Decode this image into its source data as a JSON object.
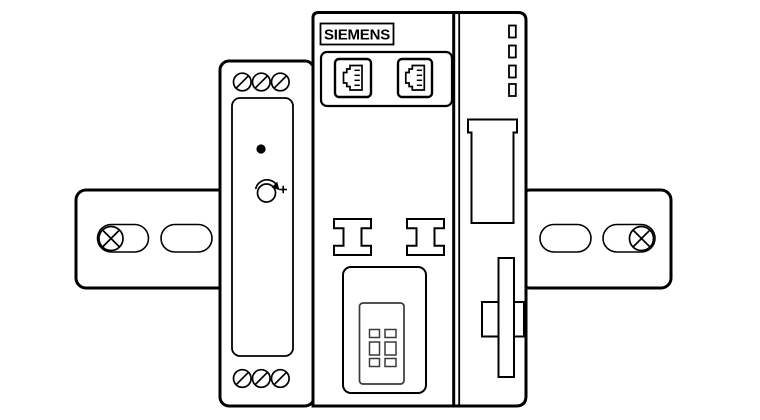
{
  "device": {
    "brand_label": "SIEMENS",
    "colors": {
      "line": "#000000",
      "background": "#ffffff",
      "detail": "#3a3a3a"
    },
    "icons": {
      "mounting_screw": "circle-with-x",
      "terminal_screw": "circle-with-slash",
      "status_led": "filled-dot",
      "potentiometer": "circle-with-clockwise-arrow-and-plus",
      "ethernet_port": "rj45-socket",
      "terminal_clamp": "i-beam",
      "led_indicator": "small-rectangle",
      "connector_socket": "grid-of-squares",
      "din_clip": "cross-slider",
      "slot_opening": "lipped-slot"
    }
  }
}
